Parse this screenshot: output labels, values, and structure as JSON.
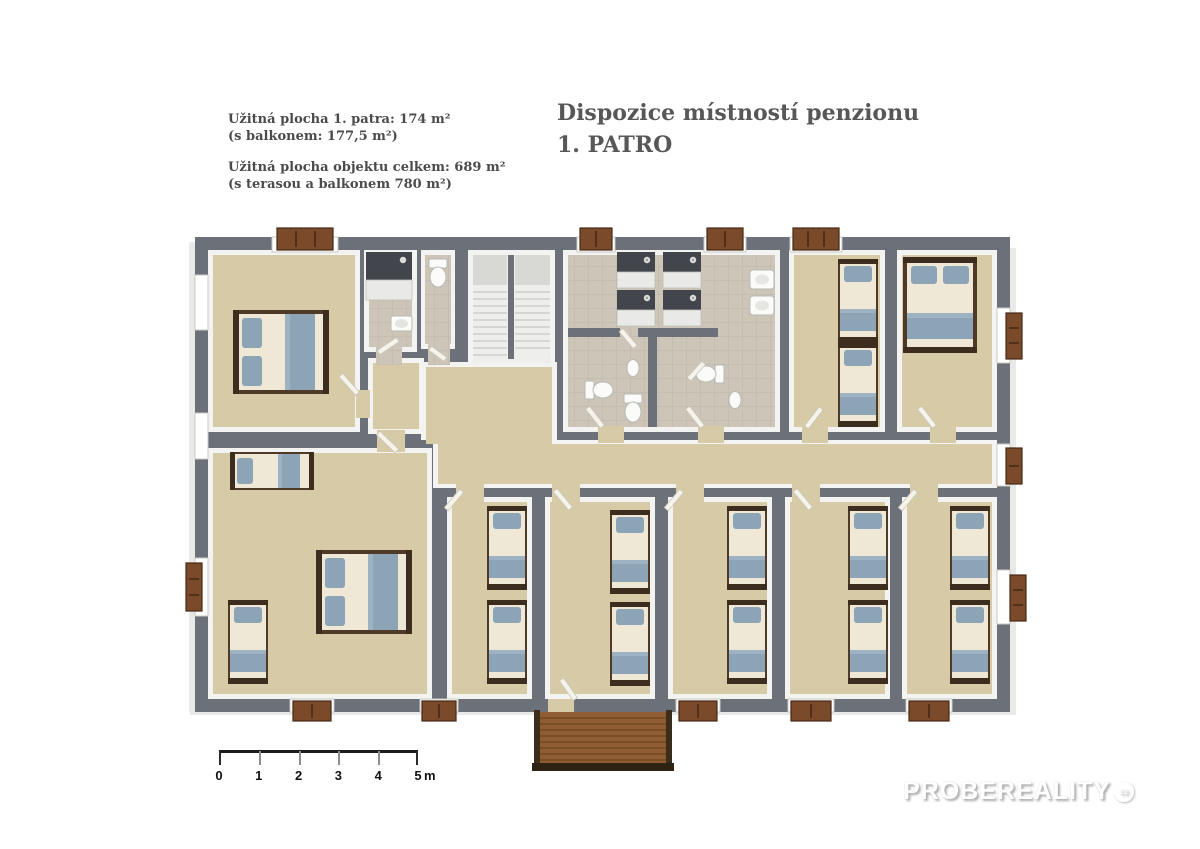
{
  "colors": {
    "wall": "#6b7079",
    "floor": "#d7caa6",
    "tile": "#ccc5b8",
    "bed_blue": "#8ca4b6",
    "bed_frame": "#4f3a28",
    "wood": "#8f5c33",
    "text": "#4b4b4b",
    "title": "#575757"
  },
  "info": {
    "line1": "Užitná plocha 1. patra: 174 m²",
    "line2": "(s balkonem: 177,5 m²)",
    "line3": "Užitná plocha objektu celkem: 689 m²",
    "line4": "(s terasou a balkonem 780 m²)"
  },
  "title": {
    "line1": "Dispozice místností penzionu",
    "line2": "1. PATRO"
  },
  "scale_bar": {
    "labels": [
      "0",
      "1",
      "2",
      "3",
      "4",
      "5"
    ],
    "unit": "m"
  },
  "watermark": {
    "text": "PROBEREALITY",
    "badge": "cz"
  }
}
